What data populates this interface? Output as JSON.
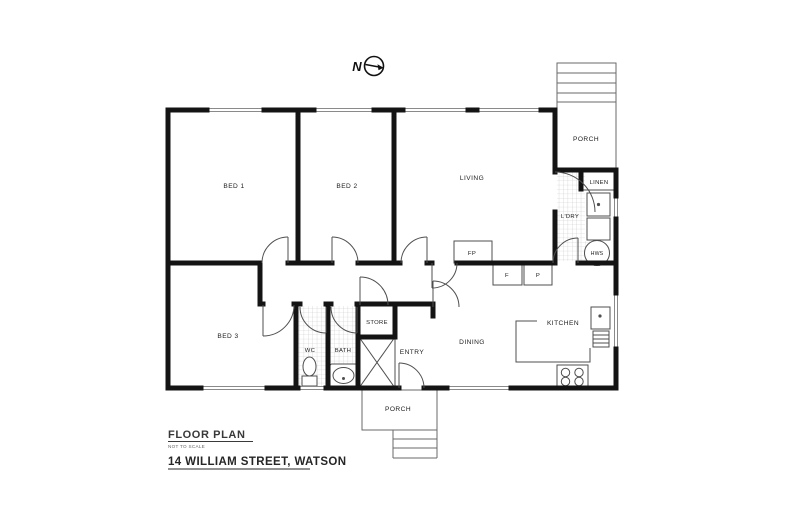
{
  "compass": {
    "label": "N"
  },
  "rooms": {
    "bed1": {
      "label": "BED 1"
    },
    "bed2": {
      "label": "BED 2"
    },
    "living": {
      "label": "LIVING"
    },
    "bed3": {
      "label": "BED 3"
    },
    "kitchen": {
      "label": "KITCHEN"
    },
    "dining": {
      "label": "DINING"
    },
    "entry": {
      "label": "ENTRY"
    },
    "wc": {
      "label": "WC"
    },
    "bath": {
      "label": "BATH"
    },
    "store": {
      "label": "STORE"
    },
    "laundry": {
      "label": "L'DRY"
    },
    "linen": {
      "label": "LINEN"
    },
    "porch_top": {
      "label": "PORCH"
    },
    "porch_bottom": {
      "label": "PORCH"
    }
  },
  "fixtures": {
    "hot_water_system": {
      "label": "HWS"
    },
    "fireplace": {
      "label": "FP"
    },
    "fridge": {
      "label": "F"
    },
    "pantry": {
      "label": "P"
    }
  },
  "title_block": {
    "title": "FLOOR PLAN",
    "scale_note": "NOT TO SCALE",
    "address": "14 WILLIAM STREET, WATSON"
  },
  "colors": {
    "wall": "#141414",
    "thin_line": "#5a5a5a",
    "tile_line": "#c8c8c8",
    "background": "#ffffff"
  }
}
